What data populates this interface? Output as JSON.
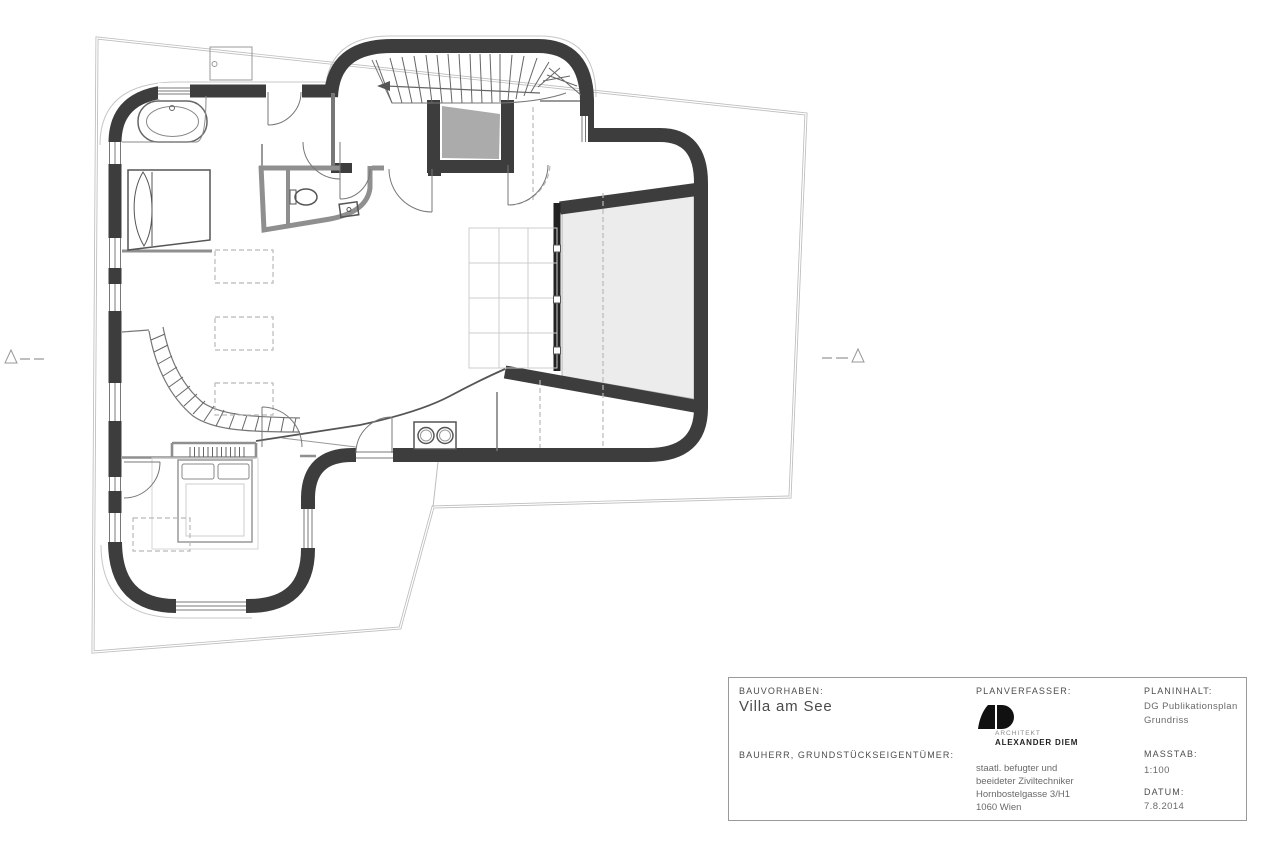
{
  "title_block": {
    "bauvorhaben_label": "BAUVORHABEN:",
    "bauvorhaben_value": "Villa am See",
    "bauherr_label": "BAUHERR, GRUNDSTÜCKSEIGENTÜMER:",
    "planverfasser_label": "PLANVERFASSER:",
    "logo": {
      "line1": "ARCHITEKT",
      "line2": "ALEXANDER DIEM"
    },
    "address": [
      "staatl. befugter und",
      "beeideter Ziviltechniker",
      "Hornbostelgasse 3/H1",
      "1060 Wien"
    ],
    "planinhalt_label": "PLANINHALT:",
    "planinhalt_line1": "DG Publikationsplan",
    "planinhalt_line2": "Grundriss",
    "masstab_label": "MASSTAB:",
    "masstab_value": "1:100",
    "datum_label": "DATUM:",
    "datum_value": "7.8.2014"
  },
  "colors": {
    "wall": "#3d3d3d",
    "gray_wall": "#8f8f8f",
    "terrace_fill": "#ececec",
    "boundary": "#bdbdbd",
    "logo": "#111111"
  }
}
